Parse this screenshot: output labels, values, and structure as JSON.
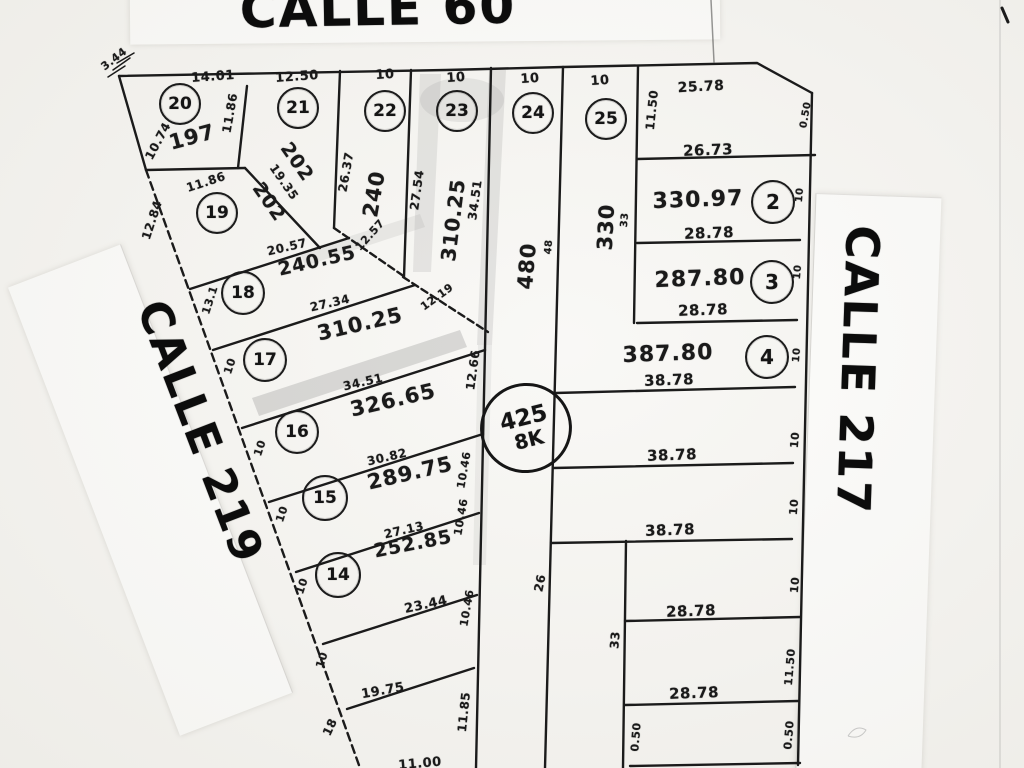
{
  "streets": {
    "top": "CALLE 60",
    "left": "CALLE 219",
    "right": "CALLE 217"
  },
  "block_marker": {
    "line1": "425",
    "line2": "8K"
  },
  "lots": [
    {
      "number": "20",
      "area": "197"
    },
    {
      "number": "21",
      "area": "202"
    },
    {
      "number": "22",
      "area": "240"
    },
    {
      "number": "23",
      "area": "310.25"
    },
    {
      "number": "24",
      "area": "480"
    },
    {
      "number": "25",
      "area": "330"
    },
    {
      "number": "2",
      "area": "330.97"
    },
    {
      "number": "3",
      "area": "287.80"
    },
    {
      "number": "4",
      "area": "387.80"
    },
    {
      "number": "19",
      "area": "202"
    },
    {
      "number": "18",
      "area": "240.55"
    },
    {
      "number": "17",
      "area": "310.25"
    },
    {
      "number": "16",
      "area": "326.65"
    },
    {
      "number": "15",
      "area": "289.75"
    },
    {
      "number": "14",
      "area": "252.85"
    }
  ],
  "dimensions": [
    "3.44",
    "14.01",
    "12.50",
    "10",
    "10",
    "10",
    "10",
    "25.78",
    "11.50",
    "26.73",
    "28.78",
    "28.78",
    "38.78",
    "38.78",
    "38.78",
    "28.78",
    "28.78",
    "11.86",
    "10.74",
    "11.86",
    "12.84",
    "19.35",
    "26.37",
    "27.54",
    "34.51",
    "20.57",
    "12.57",
    "12.19",
    "27.34",
    "13.1",
    "10",
    "34.51",
    "10",
    "30.82",
    "10",
    "27.13",
    "10",
    "23.44",
    "10",
    "19.75",
    "18",
    "11.85",
    "12.66",
    "10.46",
    "10.46",
    "10.46",
    "26",
    "48",
    "33",
    "10",
    "10",
    "10",
    "33",
    "11.50",
    "0.50",
    "0.50",
    "0.50",
    "11.00",
    "10",
    "10",
    "10"
  ]
}
